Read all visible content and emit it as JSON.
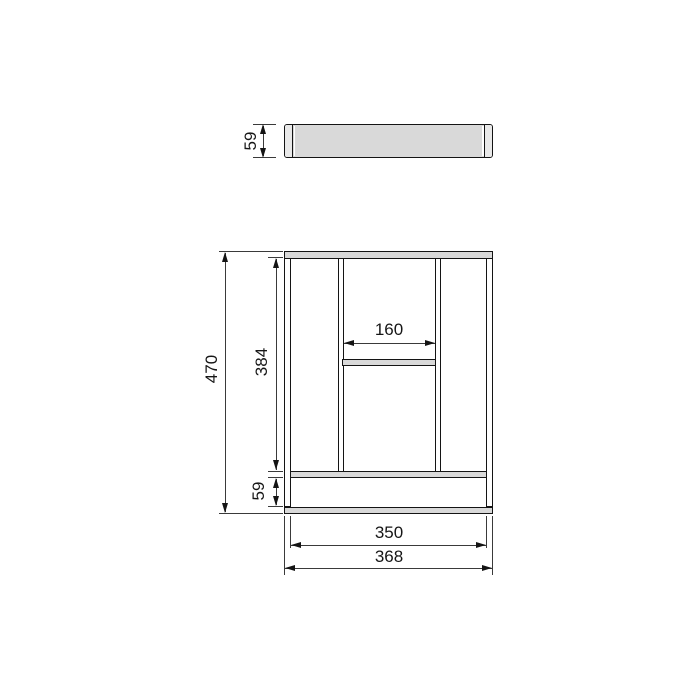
{
  "title": "cutlery-tray-technical-drawing",
  "colors": {
    "background": "#ffffff",
    "outline": "#141414",
    "dimension_line": "#3a3a3a",
    "fill_gray": "#d9d9d9",
    "fill_light": "#e9e9e9",
    "text": "#161616"
  },
  "side_view": {
    "thickness": "59"
  },
  "plan_view": {
    "overall_length": "470",
    "inner_length": "384",
    "center_compartment_width": "160",
    "front_compartment_depth": "59",
    "inner_width": "350",
    "overall_width": "368"
  }
}
